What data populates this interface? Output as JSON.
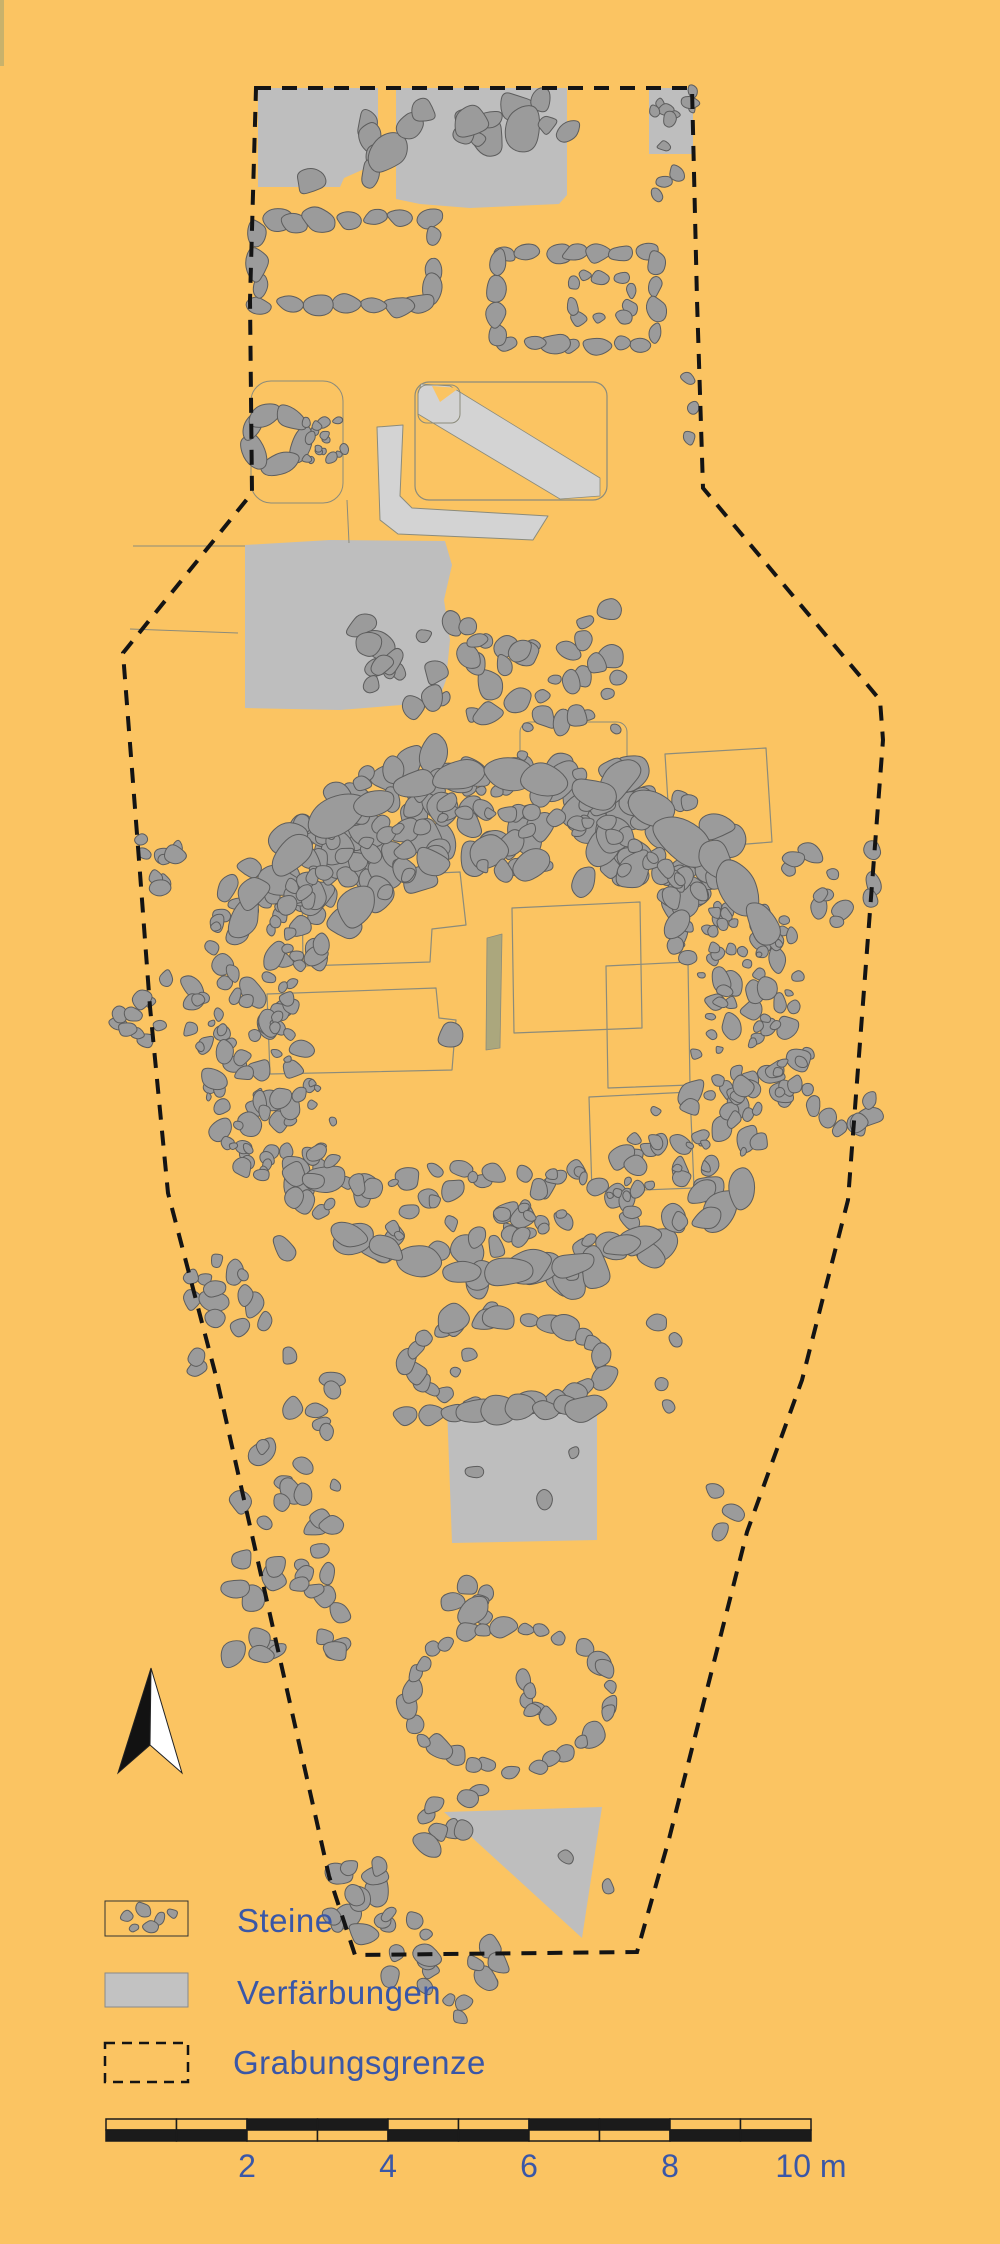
{
  "figure_type": "archaeological excavation plan",
  "colors": {
    "background": "#FBC462",
    "stone": "#9B9B9B",
    "stone_stroke": "#5D5D5D",
    "patch": "#BEBEBE",
    "band": "#D3D3D3",
    "outline": "#8B8B7B",
    "olive": "#ABA77D",
    "boundary": "#141414",
    "text_blue": "#3A57A7",
    "scale_black": "#1B1B1B",
    "legend_gray": "#C2C2C2",
    "edge_strip": "#C9B26B",
    "arrow_black": "#121212",
    "arrow_white": "#FFFFFF"
  },
  "legend": {
    "items": [
      {
        "id": "steine",
        "label": "Steine",
        "symbol": "stones-in-box"
      },
      {
        "id": "verfaerbungen",
        "label": "Verfärbungen",
        "symbol": "gray-fill-box"
      },
      {
        "id": "grabungsgrenze",
        "label": "Grabungsgrenze",
        "symbol": "dashed-box"
      }
    ]
  },
  "scalebar": {
    "x0": 106,
    "y0": 2119,
    "row_height": 11,
    "px_per_meter": 70.5,
    "total_meters": 10,
    "labels": [
      {
        "text": "2",
        "meter": 2
      },
      {
        "text": "4",
        "meter": 4
      },
      {
        "text": "6",
        "meter": 6
      },
      {
        "text": "8",
        "meter": 8
      },
      {
        "text": "10 m",
        "meter": 10
      }
    ]
  },
  "north_arrow": {
    "tip": [
      151,
      1668
    ],
    "left": [
      118,
      1773
    ],
    "right": [
      182,
      1773
    ],
    "notch": [
      150,
      1745
    ]
  },
  "map": {
    "boundary": [
      [
        256,
        88
      ],
      [
        692,
        88
      ],
      [
        697,
        300
      ],
      [
        703,
        488
      ],
      [
        880,
        700
      ],
      [
        883,
        740
      ],
      [
        848,
        1200
      ],
      [
        802,
        1380
      ],
      [
        747,
        1532
      ],
      [
        669,
        1839
      ],
      [
        637,
        1952
      ],
      [
        355,
        1955
      ],
      [
        329,
        1876
      ],
      [
        217,
        1380
      ],
      [
        168,
        1193
      ],
      [
        150,
        1007
      ],
      [
        140,
        873
      ],
      [
        123,
        653
      ],
      [
        252,
        493
      ],
      [
        250,
        300
      ]
    ],
    "features": [
      {
        "t": "rect",
        "x": 0,
        "y": 0,
        "w": 4,
        "h": 66,
        "fill": "edge_strip"
      },
      {
        "t": "poly",
        "fill": "patch",
        "pts": [
          [
            258,
            88
          ],
          [
            378,
            88
          ],
          [
            378,
            158
          ],
          [
            362,
            170
          ],
          [
            344,
            178
          ],
          [
            340,
            187
          ],
          [
            258,
            187
          ]
        ]
      },
      {
        "t": "poly",
        "fill": "patch",
        "pts": [
          [
            396,
            88
          ],
          [
            567,
            88
          ],
          [
            567,
            195
          ],
          [
            559,
            204
          ],
          [
            470,
            208
          ],
          [
            420,
            204
          ],
          [
            396,
            199
          ]
        ]
      },
      {
        "t": "rect",
        "x": 649,
        "y": 88,
        "w": 44,
        "h": 66,
        "fill": "patch"
      },
      {
        "t": "poly",
        "fill": "patch",
        "pts": [
          [
            245,
            545
          ],
          [
            330,
            540
          ],
          [
            445,
            541
          ],
          [
            452,
            565
          ],
          [
            444,
            600
          ],
          [
            450,
            640
          ],
          [
            446,
            680
          ],
          [
            438,
            702
          ],
          [
            340,
            710
          ],
          [
            245,
            708
          ]
        ]
      },
      {
        "t": "poly",
        "fill": "patch",
        "pts": [
          [
            447,
            1407
          ],
          [
            597,
            1402
          ],
          [
            597,
            1540
          ],
          [
            452,
            1543
          ]
        ]
      },
      {
        "t": "poly",
        "fill": "patch",
        "pts": [
          [
            444,
            1812
          ],
          [
            602,
            1807
          ],
          [
            582,
            1938
          ]
        ]
      },
      {
        "t": "poly",
        "fill": "band",
        "stroke": "outline",
        "sw": 1,
        "pts": [
          [
            377,
            427
          ],
          [
            403,
            425
          ],
          [
            400,
            496
          ],
          [
            412,
            508
          ],
          [
            548,
            516
          ],
          [
            533,
            540
          ],
          [
            398,
            534
          ],
          [
            380,
            520
          ]
        ]
      },
      {
        "t": "rrect",
        "x": 415,
        "y": 382,
        "w": 192,
        "h": 118,
        "r": 14,
        "stroke": "outline",
        "sw": 1.2,
        "fill": "none"
      },
      {
        "t": "poly",
        "fill": "band",
        "stroke": "outline",
        "sw": 0.8,
        "pts": [
          [
            421,
            384
          ],
          [
            450,
            386
          ],
          [
            600,
            478
          ],
          [
            600,
            496
          ],
          [
            560,
            499
          ],
          [
            418,
            414
          ],
          [
            418,
            394
          ]
        ]
      },
      {
        "t": "poly",
        "fill": "background",
        "pts": [
          [
            432,
            386
          ],
          [
            459,
            388
          ],
          [
            440,
            402
          ]
        ]
      },
      {
        "t": "rrect",
        "x": 418,
        "y": 385,
        "w": 42,
        "h": 38,
        "r": 9,
        "stroke": "outline",
        "sw": 1,
        "fill": "none"
      },
      {
        "t": "rrect",
        "x": 251,
        "y": 381,
        "w": 92,
        "h": 122,
        "r": 20,
        "stroke": "outline",
        "sw": 1,
        "fill": "none"
      },
      {
        "t": "line",
        "x1": 133,
        "y1": 546,
        "x2": 245,
        "y2": 546
      },
      {
        "t": "line",
        "x1": 130,
        "y1": 629,
        "x2": 238,
        "y2": 633
      },
      {
        "t": "line",
        "x1": 347,
        "y1": 500,
        "x2": 349,
        "y2": 543
      },
      {
        "t": "path",
        "d": "M302 879 L460 872 L466 925 L432 929 L430 962 L303 966 Z"
      },
      {
        "t": "path",
        "d": "M267 994 L436 988 L439 1018 L456 1020 L452 1070 L270 1074 Z"
      },
      {
        "t": "rrect",
        "x": 520,
        "y": 722,
        "w": 107,
        "h": 60,
        "r": 10,
        "stroke": "outline",
        "sw": 1,
        "fill": "none"
      },
      {
        "t": "path",
        "d": "M665 754 L766 748 L772 842 L671 850 Z"
      },
      {
        "t": "path",
        "d": "M512 908 L640 902 L642 1028 L514 1033 Z"
      },
      {
        "t": "path",
        "d": "M606 966 L688 962 L690 1085 L608 1088 Z"
      },
      {
        "t": "path",
        "d": "M589 1097 L690 1092 L694 1188 L592 1192 Z"
      },
      {
        "t": "poly",
        "fill": "olive",
        "stroke": "outline",
        "sw": 0.8,
        "pts": [
          [
            487,
            938
          ],
          [
            502,
            934
          ],
          [
            500,
            1048
          ],
          [
            486,
            1050
          ]
        ]
      },
      {
        "t": "srow",
        "x1": 370,
        "y1": 112,
        "x2": 372,
        "y2": 182,
        "n": 4,
        "s": [
          8,
          13
        ]
      },
      {
        "t": "st",
        "pts": [
          [
            310,
            182,
            12
          ]
        ]
      },
      {
        "t": "scl",
        "x": 388,
        "y": 92,
        "w": 185,
        "h": 72,
        "n": 15,
        "s": [
          7,
          18
        ]
      },
      {
        "t": "scl",
        "x": 648,
        "y": 90,
        "w": 46,
        "h": 62,
        "n": 10,
        "s": [
          4,
          8
        ]
      },
      {
        "t": "scl",
        "x": 652,
        "y": 160,
        "w": 34,
        "h": 36,
        "n": 3,
        "s": [
          5,
          8
        ]
      },
      {
        "t": "srect",
        "x": 258,
        "y": 220,
        "w": 176,
        "h": 85,
        "n": 20,
        "s": [
          8,
          13
        ],
        "e": 1.5
      },
      {
        "t": "srect",
        "x": 497,
        "y": 252,
        "w": 158,
        "h": 92,
        "n": 22,
        "s": [
          7,
          11
        ],
        "e": 1.4
      },
      {
        "t": "srect",
        "x": 572,
        "y": 276,
        "w": 58,
        "h": 42,
        "n": 10,
        "s": [
          5,
          8
        ],
        "e": 1.3
      },
      {
        "t": "soval",
        "cx": 276,
        "cy": 438,
        "rx": 26,
        "ry": 27,
        "n": 6,
        "s": [
          9,
          13
        ],
        "e": 1.9
      },
      {
        "t": "scl",
        "x": 306,
        "y": 420,
        "w": 40,
        "h": 42,
        "n": 16,
        "s": [
          3,
          6
        ]
      },
      {
        "t": "scl",
        "x": 352,
        "y": 618,
        "w": 102,
        "h": 100,
        "n": 17,
        "s": [
          6,
          14
        ]
      },
      {
        "t": "scl",
        "x": 465,
        "y": 618,
        "w": 102,
        "h": 108,
        "n": 18,
        "s": [
          6,
          13
        ]
      },
      {
        "t": "scl",
        "x": 568,
        "y": 606,
        "w": 52,
        "h": 112,
        "n": 12,
        "s": [
          6,
          12
        ]
      },
      {
        "t": "st",
        "pts": [
          [
            688,
            378,
            6
          ],
          [
            693,
            408,
            7
          ],
          [
            689,
            438,
            6
          ]
        ]
      },
      {
        "t": "st",
        "pts": [
          [
            528,
            727,
            5
          ],
          [
            616,
            730,
            5
          ],
          [
            547,
            866,
            6
          ]
        ]
      },
      {
        "t": "ring",
        "cx": 500,
        "cy": 1018,
        "rxo": 312,
        "ryo": 272,
        "rxi": 200,
        "ryi": 148,
        "n": 330,
        "s": [
          5,
          12
        ]
      },
      {
        "t": "ring",
        "cx": 500,
        "cy": 1018,
        "rxo": 306,
        "ryo": 265,
        "rxi": 205,
        "ryi": 152,
        "n": 150,
        "s": [
          3,
          7
        ]
      },
      {
        "t": "sarc",
        "cx": 500,
        "cy": 1018,
        "rx": 283,
        "ry": 243,
        "a1": 197,
        "a2": 343,
        "n": 15,
        "s": [
          13,
          23
        ],
        "e": 1.5
      },
      {
        "t": "sarc",
        "cx": 500,
        "cy": 1018,
        "rx": 250,
        "ry": 205,
        "a1": 205,
        "a2": 335,
        "n": 26,
        "s": [
          5,
          10
        ],
        "e": 1.2
      },
      {
        "t": "sarc",
        "cx": 500,
        "cy": 1018,
        "rx": 288,
        "ry": 252,
        "a1": 55,
        "a2": 125,
        "n": 9,
        "s": [
          12,
          20
        ],
        "e": 1.6
      },
      {
        "t": "st",
        "pts": [
          [
            450,
            1035,
            13
          ]
        ]
      },
      {
        "t": "scl",
        "x": 122,
        "y": 838,
        "w": 58,
        "h": 52,
        "n": 9,
        "s": [
          5,
          10
        ]
      },
      {
        "t": "scl",
        "x": 118,
        "y": 975,
        "w": 52,
        "h": 100,
        "n": 11,
        "s": [
          5,
          10
        ]
      },
      {
        "t": "scl",
        "x": 786,
        "y": 846,
        "w": 96,
        "h": 92,
        "n": 13,
        "s": [
          6,
          12
        ]
      },
      {
        "t": "scl",
        "x": 796,
        "y": 1086,
        "w": 78,
        "h": 58,
        "n": 8,
        "s": [
          6,
          11
        ]
      },
      {
        "t": "st",
        "pts": [
          [
            716,
            1492,
            8
          ],
          [
            734,
            1512,
            9
          ],
          [
            721,
            1531,
            7
          ]
        ]
      },
      {
        "t": "scl",
        "x": 190,
        "y": 1238,
        "w": 100,
        "h": 132,
        "n": 18,
        "s": [
          6,
          11
        ]
      },
      {
        "t": "scl",
        "x": 290,
        "y": 1378,
        "w": 52,
        "h": 58,
        "n": 6,
        "s": [
          6,
          11
        ]
      },
      {
        "t": "scl",
        "x": 228,
        "y": 1438,
        "w": 120,
        "h": 228,
        "n": 34,
        "s": [
          6,
          12
        ]
      },
      {
        "t": "st",
        "pts": [
          [
            490,
            1310,
            9
          ]
        ]
      },
      {
        "t": "soval",
        "cx": 508,
        "cy": 1363,
        "rx": 97,
        "ry": 44,
        "n": 26,
        "s": [
          7,
          13
        ],
        "e": 1.3
      },
      {
        "t": "st",
        "pts": [
          [
            452,
            1318,
            14
          ],
          [
            470,
            1355,
            7
          ],
          [
            455,
            1372,
            6
          ]
        ]
      },
      {
        "t": "st",
        "pts": [
          [
            658,
            1322,
            8
          ],
          [
            676,
            1340,
            7
          ],
          [
            662,
            1384,
            7
          ],
          [
            669,
            1406,
            6
          ]
        ]
      },
      {
        "t": "srow",
        "x1": 398,
        "y1": 1418,
        "x2": 598,
        "y2": 1405,
        "n": 9,
        "s": [
          8,
          15
        ]
      },
      {
        "t": "st",
        "pts": [
          [
            475,
            1472,
            7
          ],
          [
            545,
            1500,
            8
          ],
          [
            573,
            1452,
            6
          ]
        ]
      },
      {
        "t": "scl",
        "x": 446,
        "y": 1548,
        "w": 58,
        "h": 84,
        "n": 7,
        "s": [
          6,
          11
        ]
      },
      {
        "t": "st",
        "pts": [
          [
            472,
            1612,
            15
          ]
        ]
      },
      {
        "t": "soval",
        "cx": 508,
        "cy": 1697,
        "rx": 100,
        "ry": 72,
        "n": 30,
        "s": [
          6,
          12
        ],
        "e": 1.25
      },
      {
        "t": "scl",
        "x": 512,
        "y": 1668,
        "w": 46,
        "h": 56,
        "n": 6,
        "s": [
          5,
          9
        ]
      },
      {
        "t": "st",
        "pts": [
          [
            478,
            1790,
            7
          ]
        ]
      },
      {
        "t": "scl",
        "x": 424,
        "y": 1796,
        "w": 52,
        "h": 54,
        "n": 7,
        "s": [
          7,
          12
        ]
      },
      {
        "t": "st",
        "pts": [
          [
            566,
            1856,
            7
          ],
          [
            608,
            1886,
            6
          ]
        ]
      },
      {
        "t": "scl",
        "x": 322,
        "y": 1862,
        "w": 82,
        "h": 72,
        "n": 10,
        "s": [
          6,
          12
        ]
      },
      {
        "t": "scl",
        "x": 358,
        "y": 1902,
        "w": 92,
        "h": 76,
        "n": 10,
        "s": [
          6,
          12
        ]
      },
      {
        "t": "scl",
        "x": 416,
        "y": 1946,
        "w": 88,
        "h": 72,
        "n": 10,
        "s": [
          6,
          12
        ]
      },
      {
        "t": "boundary"
      },
      {
        "t": "north"
      },
      {
        "t": "rect",
        "x": 105,
        "y": 1901,
        "w": 83,
        "h": 35,
        "fill": "none",
        "stroke": "#333333",
        "sw": 1
      },
      {
        "t": "st",
        "pts": [
          [
            127,
            1916,
            6
          ],
          [
            143,
            1910,
            7
          ],
          [
            160,
            1919,
            5
          ],
          [
            134,
            1928,
            4
          ],
          [
            151,
            1927,
            6
          ],
          [
            172,
            1913,
            5
          ]
        ]
      },
      {
        "t": "rect",
        "x": 105,
        "y": 1973,
        "w": 83,
        "h": 34,
        "fill": "legend_gray",
        "stroke": "#8A8A8A",
        "sw": 1
      },
      {
        "t": "rect",
        "x": 105,
        "y": 2043,
        "w": 83,
        "h": 39,
        "fill": "none",
        "stroke": "boundary",
        "sw": 2.5,
        "dash": "10 7"
      },
      {
        "t": "scalebar"
      }
    ]
  }
}
